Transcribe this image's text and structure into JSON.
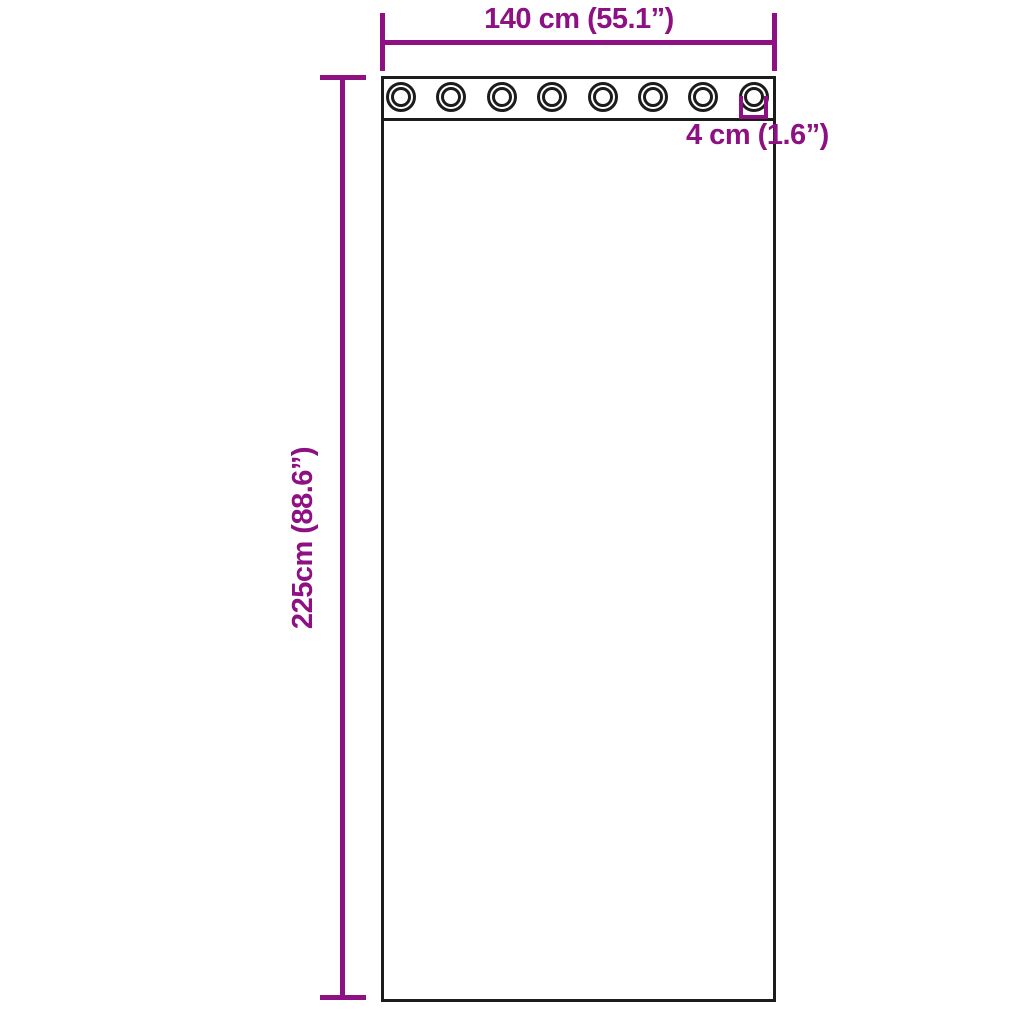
{
  "canvas": {
    "background": "#ffffff"
  },
  "colors": {
    "dimension_accent": "#8e1184",
    "outline": "#1c1c1c"
  },
  "labels": {
    "width": "140 cm (55.1”)",
    "height": "225cm (88.6”)",
    "grommet_inner_diameter": "4 cm (1.6”)"
  },
  "curtain": {
    "grommet_count": 8,
    "grommet_spacing_px": 50.4,
    "grommet_first_offset_px": 2
  }
}
